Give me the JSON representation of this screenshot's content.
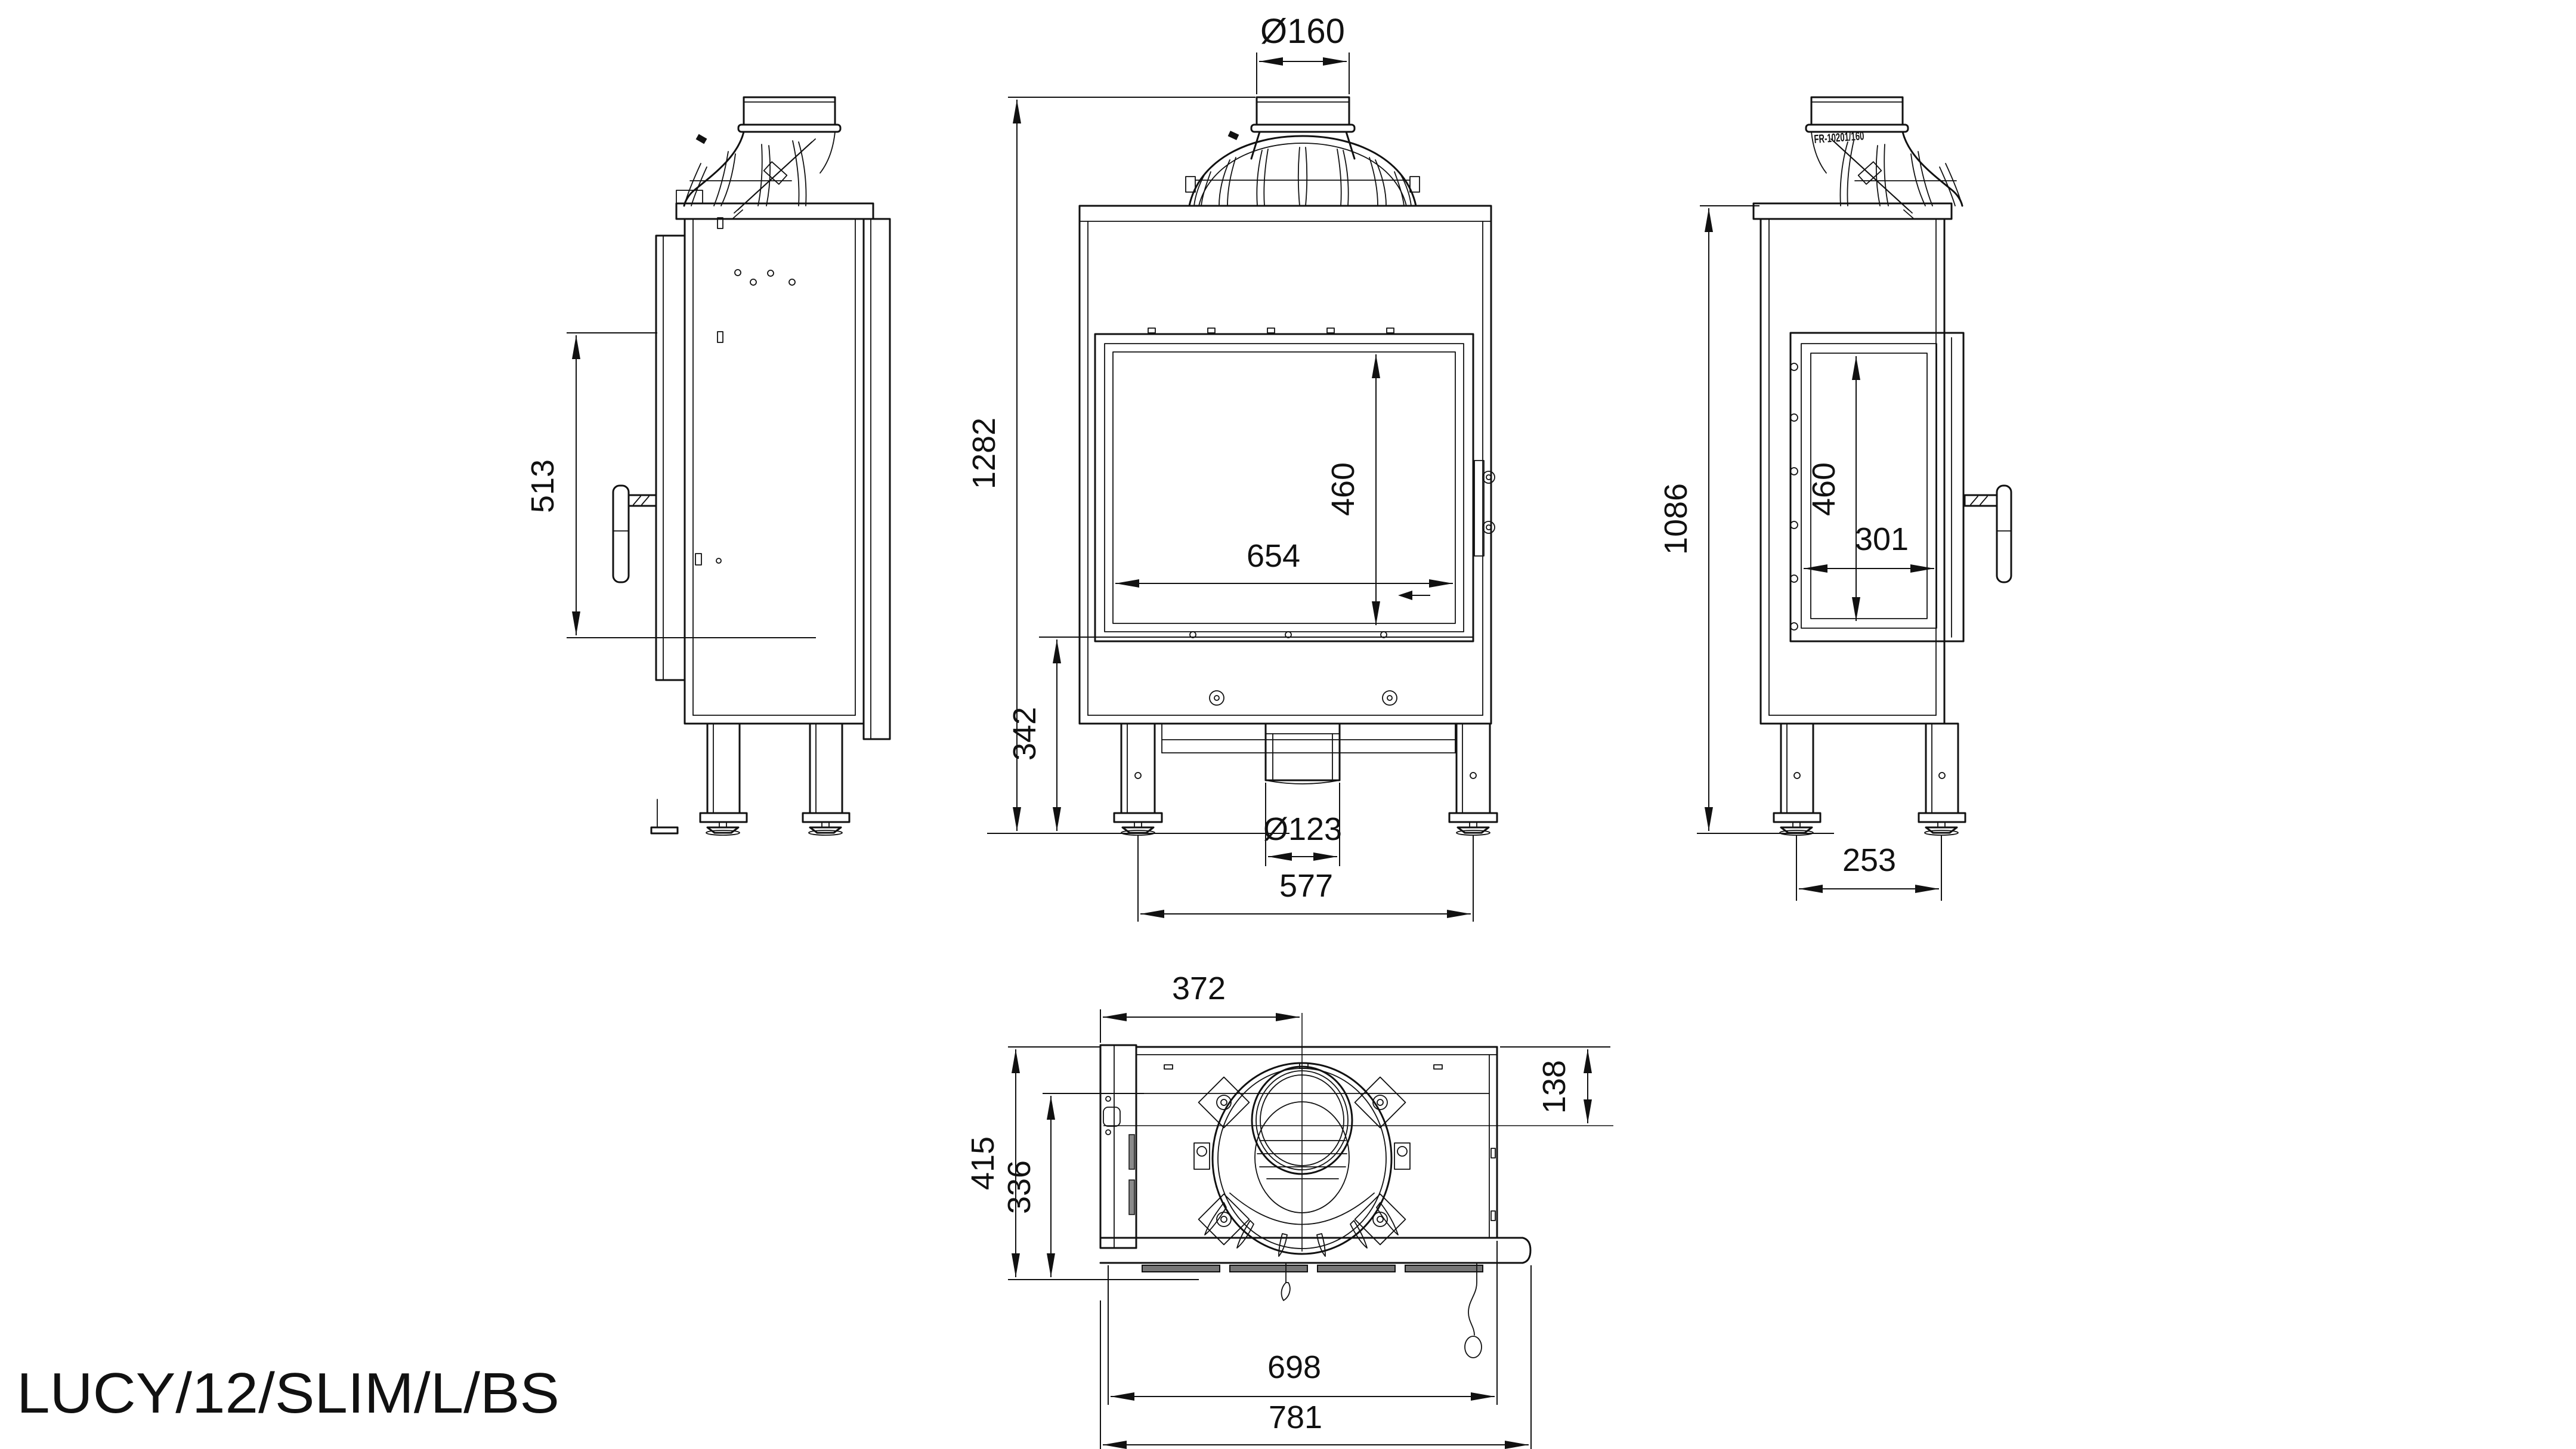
{
  "title": "LUCY/12/SLIM/L/BS",
  "labels": {
    "flue_top_diameter": "Ø160",
    "side_view": {
      "door_height": "513"
    },
    "front_view": {
      "total_height": "1282",
      "glass_height": "460",
      "glass_width": "654",
      "plinth_height": "342",
      "inlet_diameter": "Ø123",
      "feet_spacing": "577"
    },
    "side_glass_view": {
      "part_number": "FR-10201/160",
      "body_height": "1086",
      "glass_height": "460",
      "glass_width": "301",
      "feet_spacing": "253"
    },
    "top_view": {
      "flue_offset_left": "372",
      "flue_offset_back": "138",
      "depth_total": "415",
      "depth_body": "336",
      "width_body": "698",
      "width_total": "781"
    }
  }
}
